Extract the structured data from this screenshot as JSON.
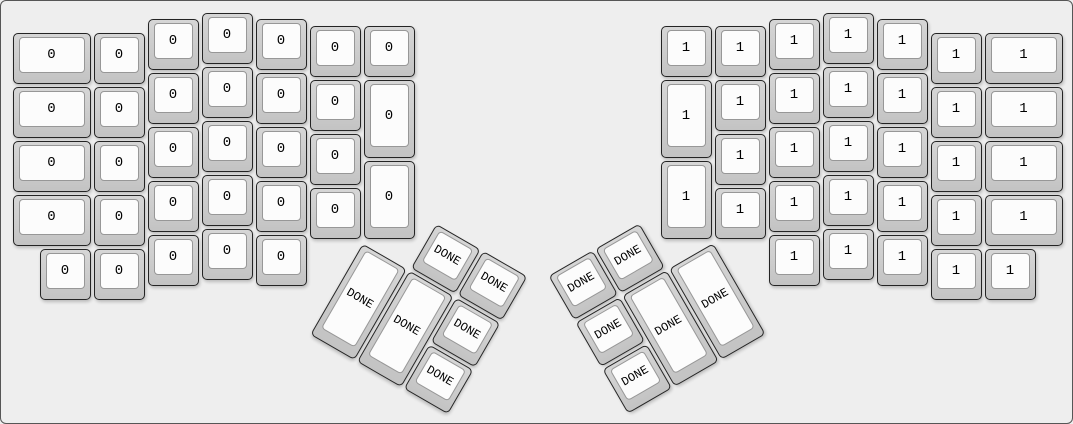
{
  "app": {
    "canvas_background": "#eeeeee",
    "canvas_border_color": "#565656"
  },
  "key_style": {
    "base_color": "#cccccc",
    "base_border_color": "#242424",
    "top_surface_color": "#fcfcfc",
    "top_surface_border_color": "#979797",
    "label_color": "#000000"
  },
  "layout": {
    "unit": 54,
    "key_inset": 1.5,
    "groups": [
      {
        "name": "left-main",
        "origin": {
          "x": 10,
          "y": 10
        },
        "rotation": 0,
        "keys": [
          {
            "x": 0,
            "y": 0.375,
            "w": 1.5,
            "h": 1,
            "label": "0"
          },
          {
            "x": 0,
            "y": 1.375,
            "w": 1.5,
            "h": 1,
            "label": "0"
          },
          {
            "x": 0,
            "y": 2.375,
            "w": 1.5,
            "h": 1,
            "label": "0"
          },
          {
            "x": 0,
            "y": 3.375,
            "w": 1.5,
            "h": 1,
            "label": "0"
          },
          {
            "x": 1.5,
            "y": 0.375,
            "w": 1,
            "h": 1,
            "label": "0"
          },
          {
            "x": 1.5,
            "y": 1.375,
            "w": 1,
            "h": 1,
            "label": "0"
          },
          {
            "x": 1.5,
            "y": 2.375,
            "w": 1,
            "h": 1,
            "label": "0"
          },
          {
            "x": 1.5,
            "y": 3.375,
            "w": 1,
            "h": 1,
            "label": "0"
          },
          {
            "x": 2.5,
            "y": 0.125,
            "w": 1,
            "h": 1,
            "label": "0"
          },
          {
            "x": 2.5,
            "y": 1.125,
            "w": 1,
            "h": 1,
            "label": "0"
          },
          {
            "x": 2.5,
            "y": 2.125,
            "w": 1,
            "h": 1,
            "label": "0"
          },
          {
            "x": 2.5,
            "y": 3.125,
            "w": 1,
            "h": 1,
            "label": "0"
          },
          {
            "x": 2.5,
            "y": 4.125,
            "w": 1,
            "h": 1,
            "label": "0"
          },
          {
            "x": 3.5,
            "y": 0,
            "w": 1,
            "h": 1,
            "label": "0"
          },
          {
            "x": 3.5,
            "y": 1,
            "w": 1,
            "h": 1,
            "label": "0"
          },
          {
            "x": 3.5,
            "y": 2,
            "w": 1,
            "h": 1,
            "label": "0"
          },
          {
            "x": 3.5,
            "y": 3,
            "w": 1,
            "h": 1,
            "label": "0"
          },
          {
            "x": 3.5,
            "y": 4,
            "w": 1,
            "h": 1,
            "label": "0"
          },
          {
            "x": 4.5,
            "y": 0.125,
            "w": 1,
            "h": 1,
            "label": "0"
          },
          {
            "x": 4.5,
            "y": 1.125,
            "w": 1,
            "h": 1,
            "label": "0"
          },
          {
            "x": 4.5,
            "y": 2.125,
            "w": 1,
            "h": 1,
            "label": "0"
          },
          {
            "x": 4.5,
            "y": 3.125,
            "w": 1,
            "h": 1,
            "label": "0"
          },
          {
            "x": 4.5,
            "y": 4.125,
            "w": 1,
            "h": 1,
            "label": "0"
          },
          {
            "x": 5.5,
            "y": 0.25,
            "w": 1,
            "h": 1,
            "label": "0"
          },
          {
            "x": 5.5,
            "y": 1.25,
            "w": 1,
            "h": 1,
            "label": "0"
          },
          {
            "x": 5.5,
            "y": 2.25,
            "w": 1,
            "h": 1,
            "label": "0"
          },
          {
            "x": 5.5,
            "y": 3.25,
            "w": 1,
            "h": 1,
            "label": "0"
          },
          {
            "x": 6.5,
            "y": 0.25,
            "w": 1,
            "h": 1,
            "label": "0"
          },
          {
            "x": 6.5,
            "y": 1.25,
            "w": 1,
            "h": 1.5,
            "label": "0"
          },
          {
            "x": 6.5,
            "y": 2.75,
            "w": 1,
            "h": 1.5,
            "label": "0"
          },
          {
            "x": 0.5,
            "y": 4.375,
            "w": 1,
            "h": 1,
            "label": "0"
          },
          {
            "x": 1.5,
            "y": 4.375,
            "w": 1,
            "h": 1,
            "label": "0"
          }
        ]
      },
      {
        "name": "right-main",
        "origin": {
          "x": 658,
          "y": 10
        },
        "rotation": 0,
        "keys": [
          {
            "x": 0,
            "y": 0.25,
            "w": 1,
            "h": 1,
            "label": "1"
          },
          {
            "x": 0,
            "y": 1.25,
            "w": 1,
            "h": 1.5,
            "label": "1"
          },
          {
            "x": 0,
            "y": 2.75,
            "w": 1,
            "h": 1.5,
            "label": "1"
          },
          {
            "x": 1,
            "y": 0.25,
            "w": 1,
            "h": 1,
            "label": "1"
          },
          {
            "x": 1,
            "y": 1.25,
            "w": 1,
            "h": 1,
            "label": "1"
          },
          {
            "x": 1,
            "y": 2.25,
            "w": 1,
            "h": 1,
            "label": "1"
          },
          {
            "x": 1,
            "y": 3.25,
            "w": 1,
            "h": 1,
            "label": "1"
          },
          {
            "x": 2,
            "y": 0.125,
            "w": 1,
            "h": 1,
            "label": "1"
          },
          {
            "x": 2,
            "y": 1.125,
            "w": 1,
            "h": 1,
            "label": "1"
          },
          {
            "x": 2,
            "y": 2.125,
            "w": 1,
            "h": 1,
            "label": "1"
          },
          {
            "x": 2,
            "y": 3.125,
            "w": 1,
            "h": 1,
            "label": "1"
          },
          {
            "x": 2,
            "y": 4.125,
            "w": 1,
            "h": 1,
            "label": "1"
          },
          {
            "x": 3,
            "y": 0,
            "w": 1,
            "h": 1,
            "label": "1"
          },
          {
            "x": 3,
            "y": 1,
            "w": 1,
            "h": 1,
            "label": "1"
          },
          {
            "x": 3,
            "y": 2,
            "w": 1,
            "h": 1,
            "label": "1"
          },
          {
            "x": 3,
            "y": 3,
            "w": 1,
            "h": 1,
            "label": "1"
          },
          {
            "x": 3,
            "y": 4,
            "w": 1,
            "h": 1,
            "label": "1"
          },
          {
            "x": 4,
            "y": 0.125,
            "w": 1,
            "h": 1,
            "label": "1"
          },
          {
            "x": 4,
            "y": 1.125,
            "w": 1,
            "h": 1,
            "label": "1"
          },
          {
            "x": 4,
            "y": 2.125,
            "w": 1,
            "h": 1,
            "label": "1"
          },
          {
            "x": 4,
            "y": 3.125,
            "w": 1,
            "h": 1,
            "label": "1"
          },
          {
            "x": 4,
            "y": 4.125,
            "w": 1,
            "h": 1,
            "label": "1"
          },
          {
            "x": 5,
            "y": 0.375,
            "w": 1,
            "h": 1,
            "label": "1"
          },
          {
            "x": 5,
            "y": 1.375,
            "w": 1,
            "h": 1,
            "label": "1"
          },
          {
            "x": 5,
            "y": 2.375,
            "w": 1,
            "h": 1,
            "label": "1"
          },
          {
            "x": 5,
            "y": 3.375,
            "w": 1,
            "h": 1,
            "label": "1"
          },
          {
            "x": 6,
            "y": 0.375,
            "w": 1.5,
            "h": 1,
            "label": "1"
          },
          {
            "x": 6,
            "y": 1.375,
            "w": 1.5,
            "h": 1,
            "label": "1"
          },
          {
            "x": 6,
            "y": 2.375,
            "w": 1.5,
            "h": 1,
            "label": "1"
          },
          {
            "x": 6,
            "y": 3.375,
            "w": 1.5,
            "h": 1,
            "label": "1"
          },
          {
            "x": 5,
            "y": 4.375,
            "w": 1,
            "h": 1,
            "label": "1"
          },
          {
            "x": 6,
            "y": 4.375,
            "w": 1,
            "h": 1,
            "label": "1"
          }
        ]
      },
      {
        "name": "left-thumb",
        "origin": {
          "x": 361,
          "y": 239.5
        },
        "rotation": 30,
        "keys": [
          {
            "x": 1,
            "y": -1,
            "w": 1,
            "h": 1,
            "label": "DONE"
          },
          {
            "x": 2,
            "y": -1,
            "w": 1,
            "h": 1,
            "label": "DONE"
          },
          {
            "x": 0,
            "y": 0,
            "w": 1,
            "h": 2,
            "label": "DONE"
          },
          {
            "x": 1,
            "y": 0,
            "w": 1,
            "h": 2,
            "label": "DONE"
          },
          {
            "x": 2,
            "y": 0,
            "w": 1,
            "h": 1,
            "label": "DONE"
          },
          {
            "x": 2,
            "y": 1,
            "w": 1,
            "h": 1,
            "label": "DONE"
          }
        ]
      },
      {
        "name": "right-thumb",
        "origin": {
          "x": 712,
          "y": 239.5
        },
        "rotation": -30,
        "keys": [
          {
            "x": -2,
            "y": -1,
            "w": 1,
            "h": 1,
            "label": "DONE"
          },
          {
            "x": -3,
            "y": -1,
            "w": 1,
            "h": 1,
            "label": "DONE"
          },
          {
            "x": -1,
            "y": 0,
            "w": 1,
            "h": 2,
            "label": "DONE"
          },
          {
            "x": -2,
            "y": 0,
            "w": 1,
            "h": 2,
            "label": "DONE"
          },
          {
            "x": -3,
            "y": 0,
            "w": 1,
            "h": 1,
            "label": "DONE"
          },
          {
            "x": -3,
            "y": 1,
            "w": 1,
            "h": 1,
            "label": "DONE"
          }
        ]
      }
    ]
  }
}
